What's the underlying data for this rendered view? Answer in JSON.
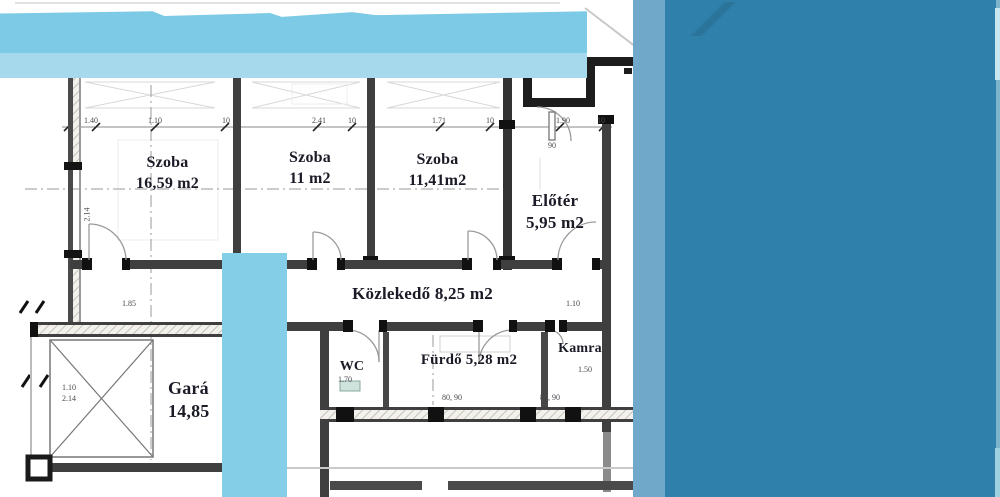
{
  "page": {
    "background": "#ffffff"
  },
  "overlays": {
    "banner": {
      "color_top": "#7ccae5",
      "color_bottom": "#a6d9ec"
    },
    "stripe": {
      "color": "#84cee8"
    },
    "column": {
      "color": "#6fa8c9"
    },
    "panel": {
      "color": "#2f81ac"
    },
    "edge_mid": "#7db6ca",
    "edge_light": "#c6e7f0",
    "edge_bottom": "#9fd2e0"
  },
  "floorplan": {
    "rooms": [
      {
        "name": "Szoba",
        "area": "16,59 m2"
      },
      {
        "name": "Szoba",
        "area": "11 m2"
      },
      {
        "name": "Szoba",
        "area": "11,41m2"
      },
      {
        "name": "Előtér",
        "area": "5,95 m2"
      },
      {
        "name": "Közlekedő 8,25 m2",
        "area": ""
      },
      {
        "name": "WC",
        "area": ""
      },
      {
        "name": "Fürdő 5,28 m2",
        "area": ""
      },
      {
        "name": "Kamra",
        "area": ""
      },
      {
        "name": "Gará",
        "area": "14,85"
      }
    ],
    "dimensions": [
      {
        "text": "1.40",
        "x": 84,
        "y": 116
      },
      {
        "text": "1.10",
        "x": 148,
        "y": 116
      },
      {
        "text": "10",
        "x": 222,
        "y": 116
      },
      {
        "text": "2.41",
        "x": 312,
        "y": 116
      },
      {
        "text": "10",
        "x": 348,
        "y": 116
      },
      {
        "text": "1.71",
        "x": 432,
        "y": 116
      },
      {
        "text": "10",
        "x": 486,
        "y": 116
      },
      {
        "text": "1.90",
        "x": 556,
        "y": 116
      },
      {
        "text": "10",
        "x": 597,
        "y": 116
      },
      {
        "text": "90",
        "x": 548,
        "y": 141
      },
      {
        "text": "2.14",
        "x": 80,
        "y": 210,
        "rot": -90
      },
      {
        "text": "1.85",
        "x": 122,
        "y": 299
      },
      {
        "text": "1.10",
        "x": 566,
        "y": 299
      },
      {
        "text": "1.10",
        "x": 62,
        "y": 383
      },
      {
        "text": "2.14",
        "x": 62,
        "y": 394
      },
      {
        "text": "1.70",
        "x": 338,
        "y": 375
      },
      {
        "text": "1.50",
        "x": 578,
        "y": 365
      },
      {
        "text": "80, 90",
        "x": 442,
        "y": 393
      },
      {
        "text": "80, 90",
        "x": 540,
        "y": 393
      }
    ]
  }
}
